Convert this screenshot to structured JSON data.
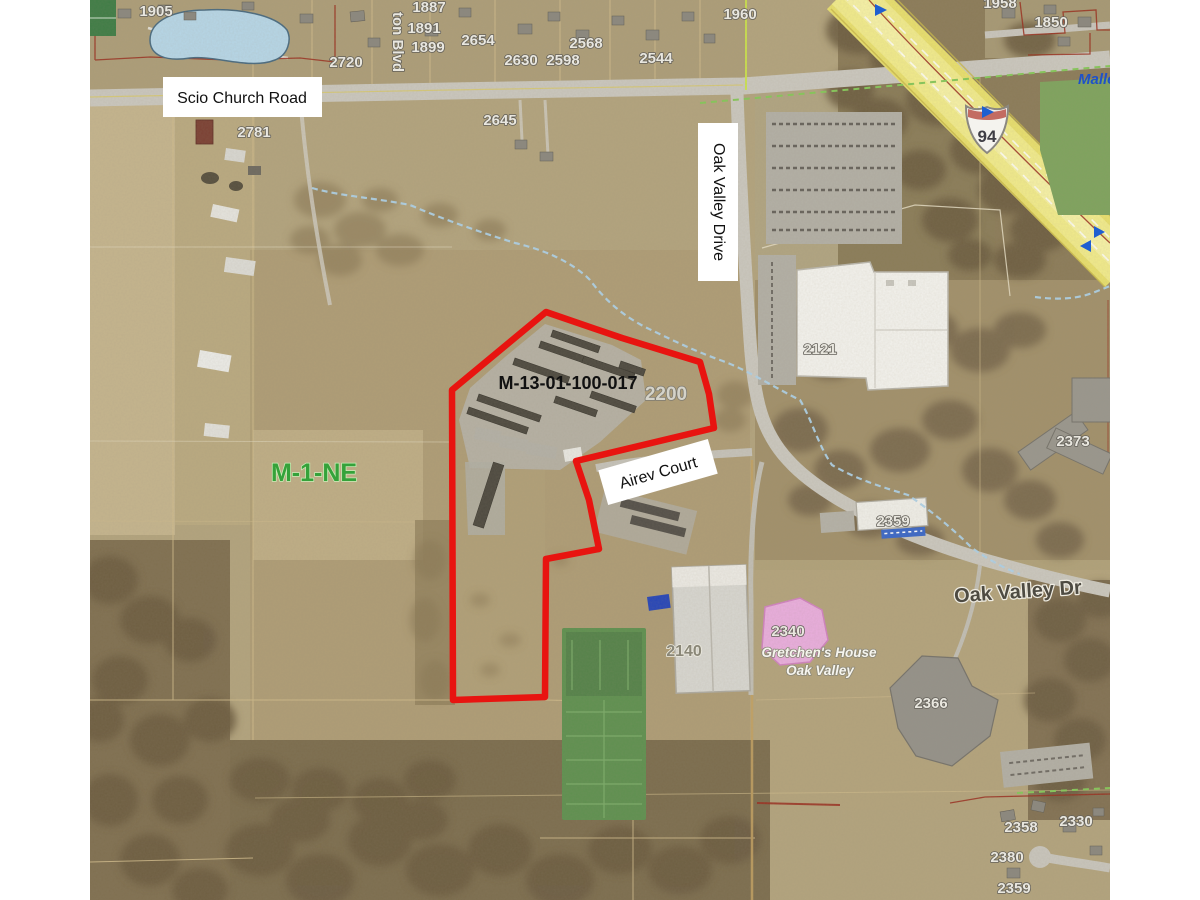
{
  "annotations": {
    "parcel_id": "M-13-01-100-017",
    "zoning_label": "M-1-NE",
    "scio_church_road": "Scio Church Road",
    "oak_valley_drive": "Oak Valley Drive",
    "airev_court": "Airev Court",
    "oak_valley_dr_map": "Oak Valley Dr",
    "street_blvd": "ton Blvd",
    "creek_label": "Malle",
    "interstate_number": "94",
    "business_line1": "Gretchen's House",
    "business_line2": "Oak Valley"
  },
  "nums": {
    "n1905": "1905",
    "n1887": "1887",
    "n1891": "1891",
    "n1899": "1899",
    "n2654": "2654",
    "n2630": "2630",
    "n2598": "2598",
    "n2568": "2568",
    "n2544": "2544",
    "n2720": "2720",
    "n1960": "1960",
    "n1958": "1958",
    "n1850": "1850",
    "n2781": "2781",
    "n2645": "2645",
    "n2200": "2200",
    "n2121": "2121",
    "n2373": "2373",
    "n2359": "2359",
    "n2340": "2340",
    "n2366": "2366",
    "n2140": "2140",
    "n2358": "2358",
    "n2330": "2330",
    "n2380": "2380",
    "n2359b": "2359"
  },
  "colors": {
    "parcel_outline": "#e81410",
    "zoning_green": "#35a23a",
    "highway_yellow": "#e9e06e",
    "water_blue": "#b7d7e8",
    "pink_building": "#eaaede",
    "marker_blue": "#1f5fd0"
  }
}
